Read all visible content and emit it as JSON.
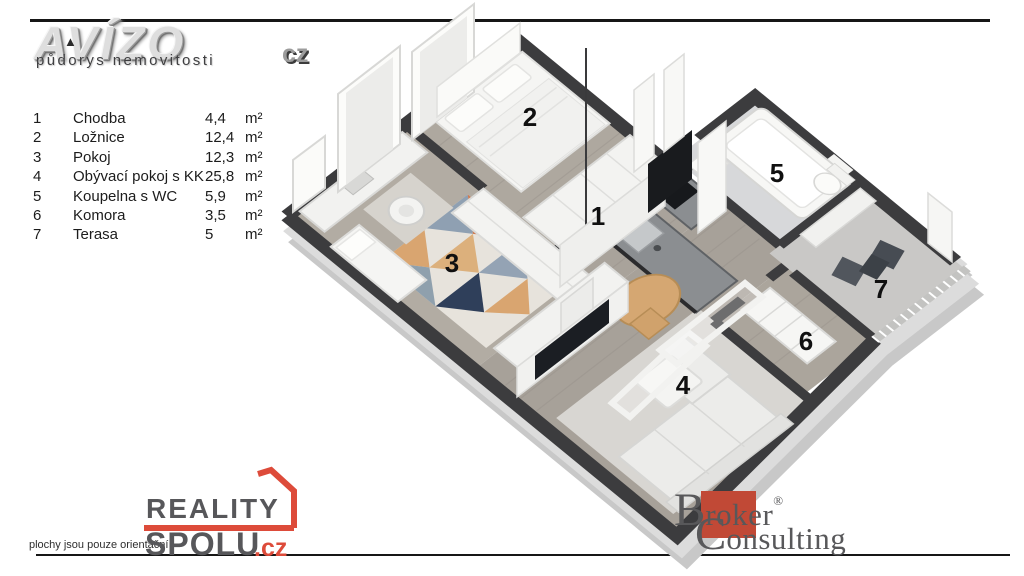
{
  "header": {
    "brand": "AVÍZO",
    "logo_mark": "▲",
    "subtitle": "půdorys nemovitosti",
    "brand_tld": "cz"
  },
  "legend": {
    "rooms": [
      {
        "number": "1",
        "name": "Chodba",
        "area": "4,4",
        "unit": "m²"
      },
      {
        "number": "2",
        "name": "Ložnice",
        "area": "12,4",
        "unit": "m²"
      },
      {
        "number": "3",
        "name": "Pokoj",
        "area": "12,3",
        "unit": "m²"
      },
      {
        "number": "4",
        "name": "Obývací pokoj s KK",
        "area": "25,8",
        "unit": "m²"
      },
      {
        "number": "5",
        "name": "Koupelna s WC",
        "area": "5,9",
        "unit": "m²"
      },
      {
        "number": "6",
        "name": "Komora",
        "area": "3,5",
        "unit": "m²"
      },
      {
        "number": "7",
        "name": "Terasa",
        "area": "5",
        "unit": "m²"
      }
    ]
  },
  "footer": {
    "disclaimer": "plochy jsou pouze orientační",
    "reality": {
      "word1": "REALITY",
      "word2": "SPOLU",
      "tld": ".cz",
      "accent_color": "#dd4b3a"
    },
    "broker": {
      "initial1": "B",
      "rest1": "roker",
      "registered": "®",
      "initial2": "C",
      "rest2": "onsulting",
      "square_color": "#c14936"
    }
  },
  "plan": {
    "colors": {
      "wall": "#3c3c3e",
      "wall_base": "#c8c8c8",
      "floor_wood": "#aca69d",
      "floor_bath": "#d7d8da",
      "floor_terrace": "#c9c8c6",
      "counter": "#8b8e91",
      "appliance": "#17191c",
      "furniture_white": "#f2f2f0",
      "table_wood": "#d5a772"
    }
  }
}
